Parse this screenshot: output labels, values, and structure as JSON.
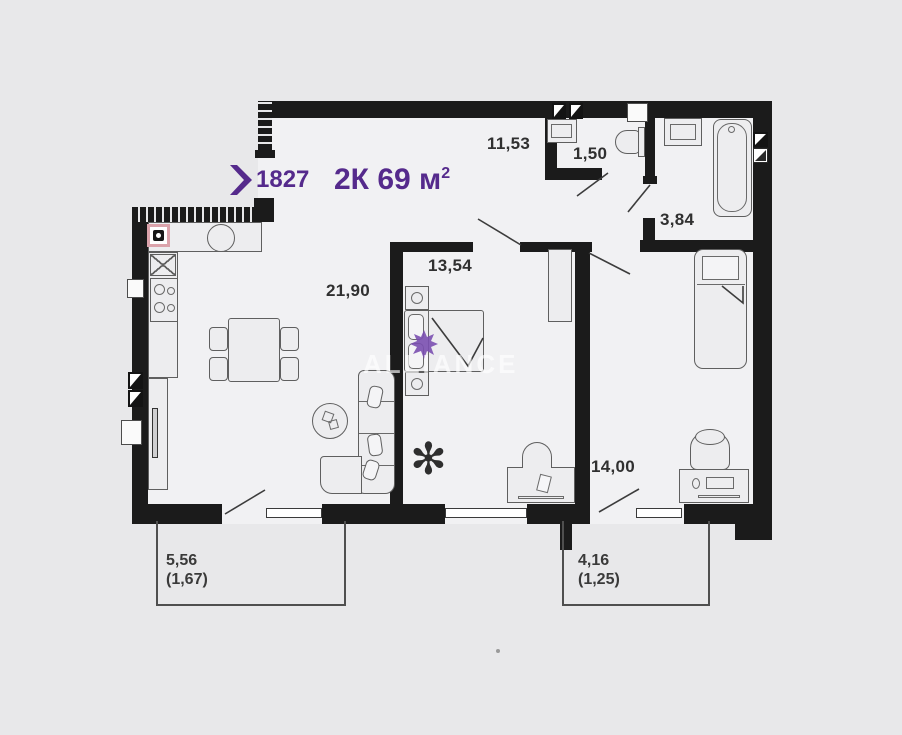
{
  "header": {
    "unit_number": "1827",
    "title_rooms": "2К",
    "title_area": "69 м",
    "title_area_exp": "2"
  },
  "watermark": {
    "text": "ALLIANCE"
  },
  "rooms": [
    {
      "id": "kitchen-living",
      "area": "21,90"
    },
    {
      "id": "hallway",
      "area": "11,53"
    },
    {
      "id": "wc",
      "area": "1,50"
    },
    {
      "id": "bathroom",
      "area": "3,84"
    },
    {
      "id": "bedroom",
      "area": "13,54"
    },
    {
      "id": "bedroom-2",
      "area": "14,00"
    }
  ],
  "balconies": [
    {
      "id": "balcony-left",
      "area": "5,56",
      "area_reduced": "(1,67)"
    },
    {
      "id": "balcony-right",
      "area": "4,16",
      "area_reduced": "(1,25)"
    }
  ],
  "colors": {
    "accent": "#552a8c",
    "wall": "#1b1b1b",
    "gas_marker": "#dba3ab"
  }
}
